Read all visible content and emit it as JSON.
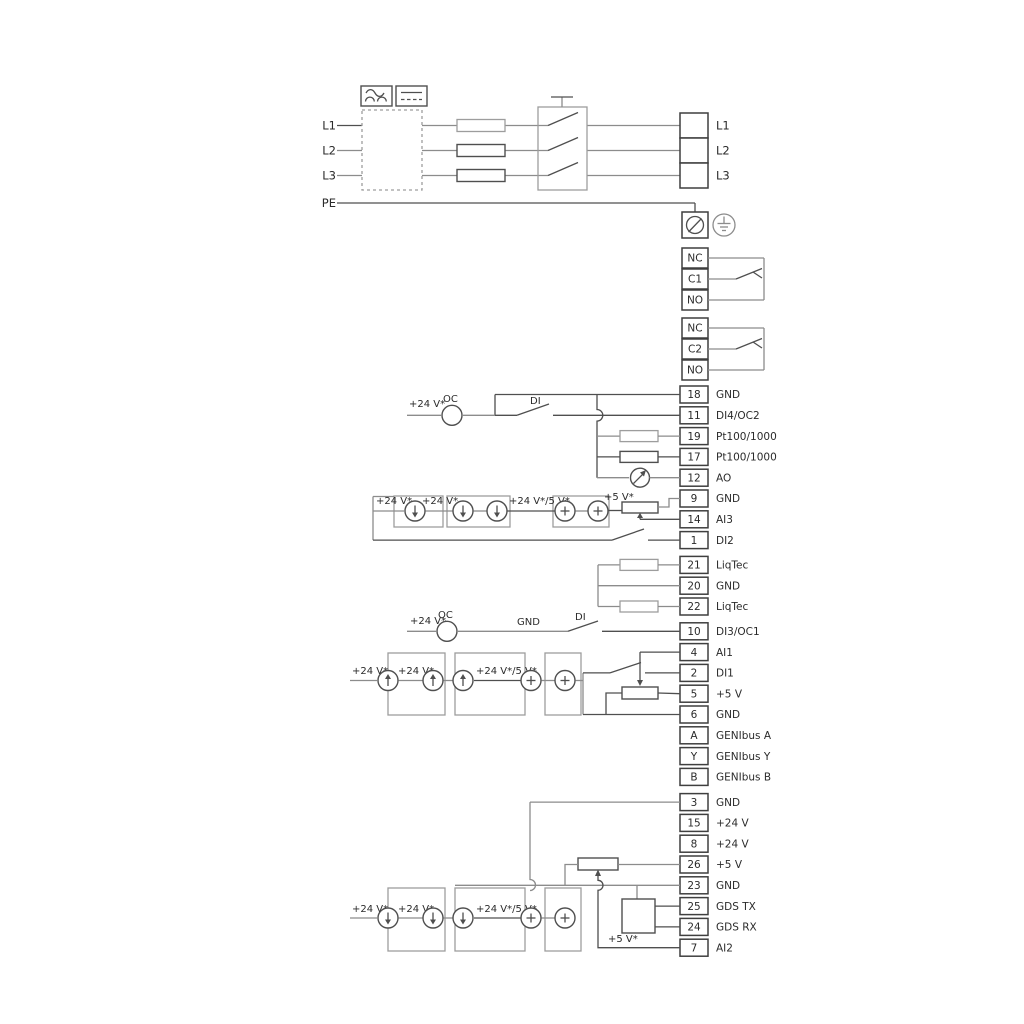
{
  "colors": {
    "wire_gray": "#8c8c8c",
    "wire_dark": "#4f4f4f",
    "text": "#2b2b2b",
    "background": "#ffffff"
  },
  "mains": {
    "left_labels": [
      "L1",
      "L2",
      "L3",
      "PE"
    ],
    "output_labels": [
      "L1",
      "L2",
      "L3"
    ]
  },
  "relay1": [
    "NC",
    "C1",
    "NO"
  ],
  "relay2": [
    "NC",
    "C2",
    "NO"
  ],
  "io1": [
    {
      "n": "18",
      "l": "GND"
    },
    {
      "n": "11",
      "l": "DI4/OC2"
    },
    {
      "n": "19",
      "l": "Pt100/1000"
    },
    {
      "n": "17",
      "l": "Pt100/1000"
    },
    {
      "n": "12",
      "l": "AO"
    },
    {
      "n": "9",
      "l": "GND"
    },
    {
      "n": "14",
      "l": "AI3"
    },
    {
      "n": "1",
      "l": "DI2"
    }
  ],
  "liqtec": [
    {
      "n": "21",
      "l": "LiqTec"
    },
    {
      "n": "20",
      "l": "GND"
    },
    {
      "n": "22",
      "l": "LiqTec"
    }
  ],
  "io2": [
    {
      "n": "10",
      "l": "DI3/OC1"
    },
    {
      "n": "4",
      "l": "AI1"
    },
    {
      "n": "2",
      "l": "DI1"
    },
    {
      "n": "5",
      "l": "+5 V"
    },
    {
      "n": "6",
      "l": "GND"
    },
    {
      "n": "A",
      "l": "GENIbus A"
    },
    {
      "n": "Y",
      "l": "GENIbus Y"
    },
    {
      "n": "B",
      "l": "GENIbus B"
    }
  ],
  "io3": [
    {
      "n": "3",
      "l": "GND"
    },
    {
      "n": "15",
      "l": "+24 V"
    },
    {
      "n": "8",
      "l": "+24 V"
    },
    {
      "n": "26",
      "l": "+5 V"
    },
    {
      "n": "23",
      "l": "GND"
    },
    {
      "n": "25",
      "l": "GDS TX"
    },
    {
      "n": "24",
      "l": "GDS RX"
    },
    {
      "n": "7",
      "l": "AI2"
    }
  ],
  "ann": {
    "v24": "+24 V*",
    "v24v5": "+24 V*/5 V*",
    "v5": "+5 V*",
    "oc": "OC",
    "di": "DI",
    "gnd": "GND"
  }
}
